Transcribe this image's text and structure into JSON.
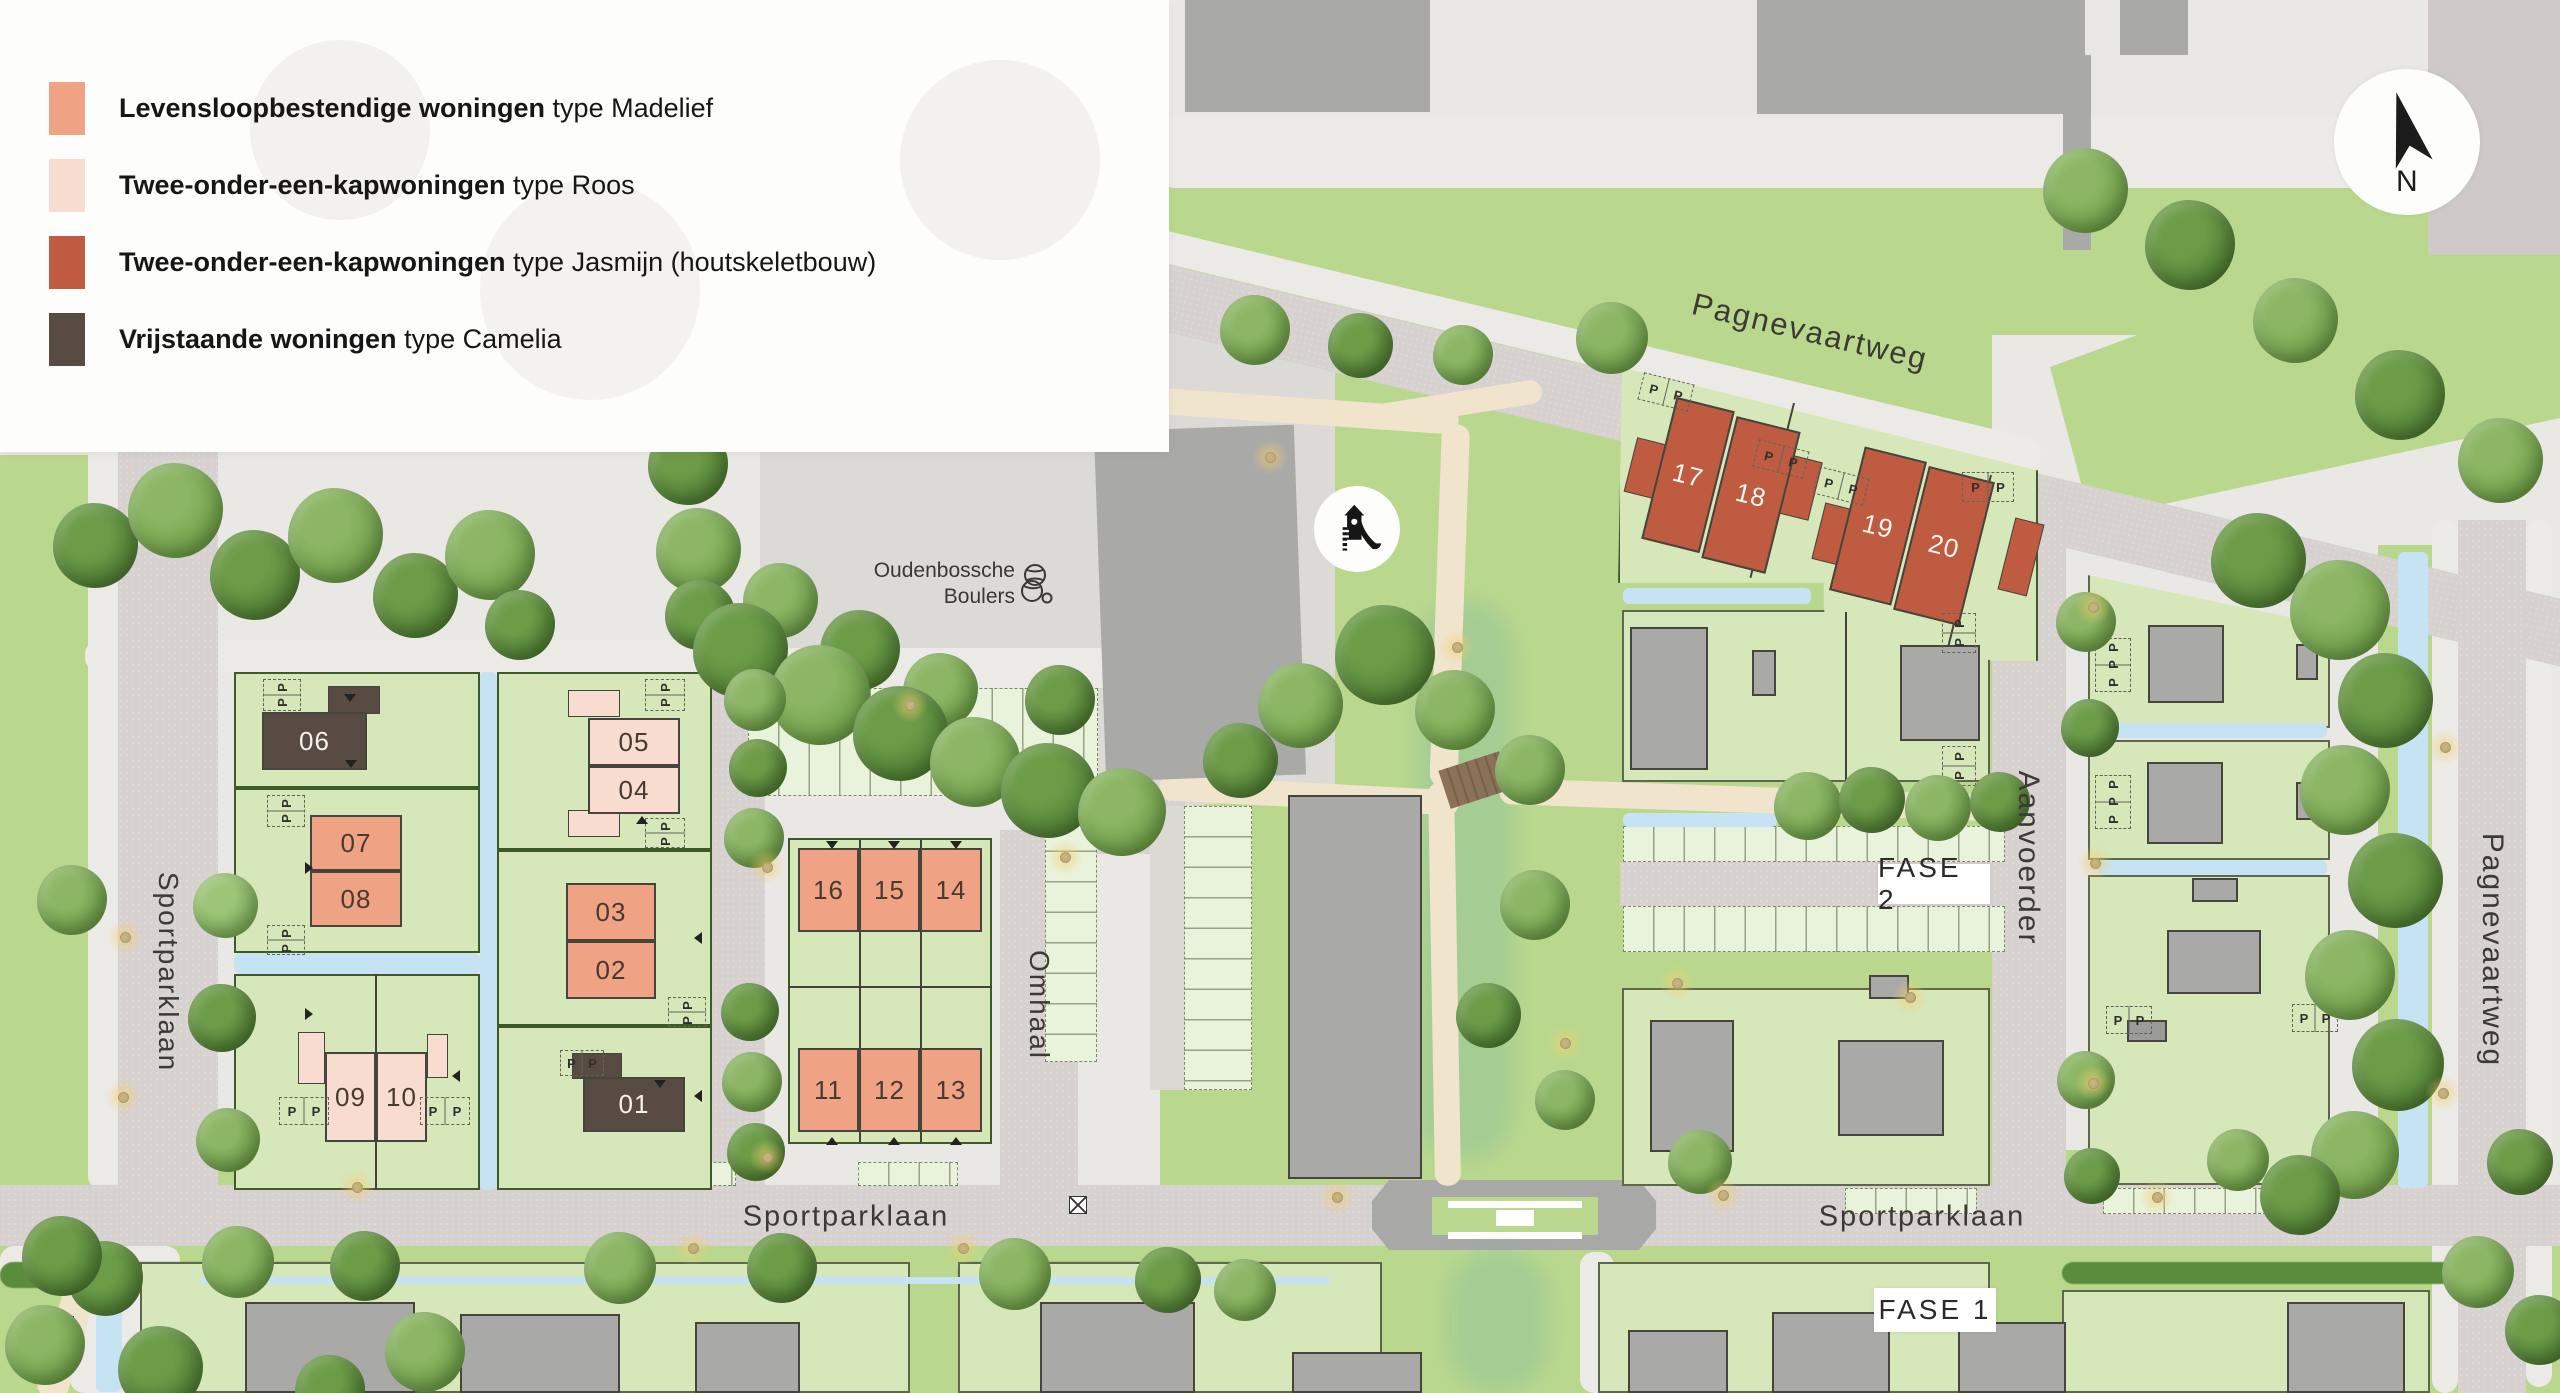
{
  "legend": {
    "items": [
      {
        "swatch": "#f0a285",
        "bold": "Levensloopbestendige woningen",
        "rest": "type Madelief"
      },
      {
        "swatch": "#f8dcd0",
        "bold": "Twee-onder-een-kapwoningen",
        "rest": "type Roos"
      },
      {
        "swatch": "#bf5b40",
        "bold": "Twee-onder-een-kapwoningen",
        "rest": "type Jasmijn (houtskeletbouw)"
      },
      {
        "swatch": "#584b43",
        "bold": "Vrijstaande woningen",
        "rest": "type Camelia"
      }
    ]
  },
  "compass": {
    "label": "N"
  },
  "labels": {
    "fase1": "FASE 1",
    "fase2": "FASE 2",
    "boulers_line1": "Oudenbossche",
    "boulers_line2": "Boulers"
  },
  "parking": {
    "letter": "P"
  },
  "streets": [
    {
      "name": "Pagnevaartweg",
      "x": 1810,
      "y": 332,
      "rot": 13.5,
      "size": 31
    },
    {
      "name": "Pagnevaartweg",
      "x": 2492,
      "y": 950,
      "rot": 90,
      "size": 30
    },
    {
      "name": "Aanvoerder",
      "x": 2028,
      "y": 858,
      "rot": 90,
      "size": 30
    },
    {
      "name": "Omhaal",
      "x": 1039,
      "y": 1005,
      "rot": 90,
      "size": 28
    },
    {
      "name": "Sportparklaan",
      "x": 168,
      "y": 972,
      "rot": 90,
      "size": 28
    },
    {
      "name": "Sportparklaan",
      "x": 846,
      "y": 1217,
      "rot": 0,
      "size": 29
    },
    {
      "name": "Sportparklaan",
      "x": 1922,
      "y": 1217,
      "rot": 0,
      "size": 29
    }
  ],
  "plots": [
    {
      "num": "01",
      "x": 583,
      "y": 1077,
      "w": 102,
      "h": 55,
      "fill": "#584b43",
      "text": "#f4f1ee"
    },
    {
      "num": "02",
      "x": 566,
      "y": 941,
      "w": 90,
      "h": 58,
      "fill": "#f0a285",
      "text": "#473a31"
    },
    {
      "num": "03",
      "x": 566,
      "y": 883,
      "w": 90,
      "h": 58,
      "fill": "#f0a285",
      "text": "#473a31"
    },
    {
      "num": "04",
      "x": 588,
      "y": 766,
      "w": 92,
      "h": 48,
      "fill": "#f8dcd0",
      "text": "#473a31"
    },
    {
      "num": "05",
      "x": 588,
      "y": 718,
      "w": 92,
      "h": 48,
      "fill": "#f8dcd0",
      "text": "#473a31"
    },
    {
      "num": "06",
      "x": 262,
      "y": 712,
      "w": 105,
      "h": 58,
      "fill": "#584b43",
      "text": "#f4f1ee"
    },
    {
      "num": "07",
      "x": 310,
      "y": 815,
      "w": 92,
      "h": 56,
      "fill": "#f0a285",
      "text": "#473a31"
    },
    {
      "num": "08",
      "x": 310,
      "y": 871,
      "w": 92,
      "h": 56,
      "fill": "#f0a285",
      "text": "#473a31"
    },
    {
      "num": "09",
      "x": 325,
      "y": 1052,
      "w": 51,
      "h": 90,
      "fill": "#f8dcd0",
      "text": "#473a31"
    },
    {
      "num": "10",
      "x": 376,
      "y": 1052,
      "w": 51,
      "h": 90,
      "fill": "#f8dcd0",
      "text": "#473a31"
    },
    {
      "num": "11",
      "x": 798,
      "y": 1048,
      "w": 61,
      "h": 84,
      "fill": "#f0a285",
      "text": "#473a31"
    },
    {
      "num": "12",
      "x": 859,
      "y": 1048,
      "w": 61,
      "h": 84,
      "fill": "#f0a285",
      "text": "#473a31"
    },
    {
      "num": "13",
      "x": 920,
      "y": 1048,
      "w": 62,
      "h": 84,
      "fill": "#f0a285",
      "text": "#473a31"
    },
    {
      "num": "14",
      "x": 920,
      "y": 848,
      "w": 62,
      "h": 84,
      "fill": "#f0a285",
      "text": "#473a31"
    },
    {
      "num": "15",
      "x": 859,
      "y": 848,
      "w": 61,
      "h": 84,
      "fill": "#f0a285",
      "text": "#473a31"
    },
    {
      "num": "16",
      "x": 798,
      "y": 848,
      "w": 61,
      "h": 84,
      "fill": "#f0a285",
      "text": "#473a31"
    },
    {
      "num": "17",
      "x": 1658,
      "y": 402,
      "w": 60,
      "h": 146,
      "fill": "#bf5b40",
      "text": "#fdf6f2",
      "rot": 14
    },
    {
      "num": "18",
      "x": 1718,
      "y": 422,
      "w": 66,
      "h": 146,
      "fill": "#bf5b40",
      "text": "#fdf6f2",
      "rot": 14
    },
    {
      "num": "19",
      "x": 1846,
      "y": 452,
      "w": 64,
      "h": 148,
      "fill": "#bf5b40",
      "text": "#fdf6f2",
      "rot": 14
    },
    {
      "num": "20",
      "x": 1910,
      "y": 472,
      "w": 68,
      "h": 148,
      "fill": "#bf5b40",
      "text": "#fdf6f2",
      "rot": 14
    }
  ],
  "colors": {
    "grass": "#b9d88e",
    "plot_green": "#d6e7ba",
    "road": "#d7d1d0",
    "water": "#c6e3f4",
    "madelief": "#f0a285",
    "roos": "#f8dcd0",
    "jasmijn": "#bf5b40",
    "camelia": "#584b43",
    "building_gray": "#a9a9a7",
    "border_green": "#3d5a27"
  }
}
